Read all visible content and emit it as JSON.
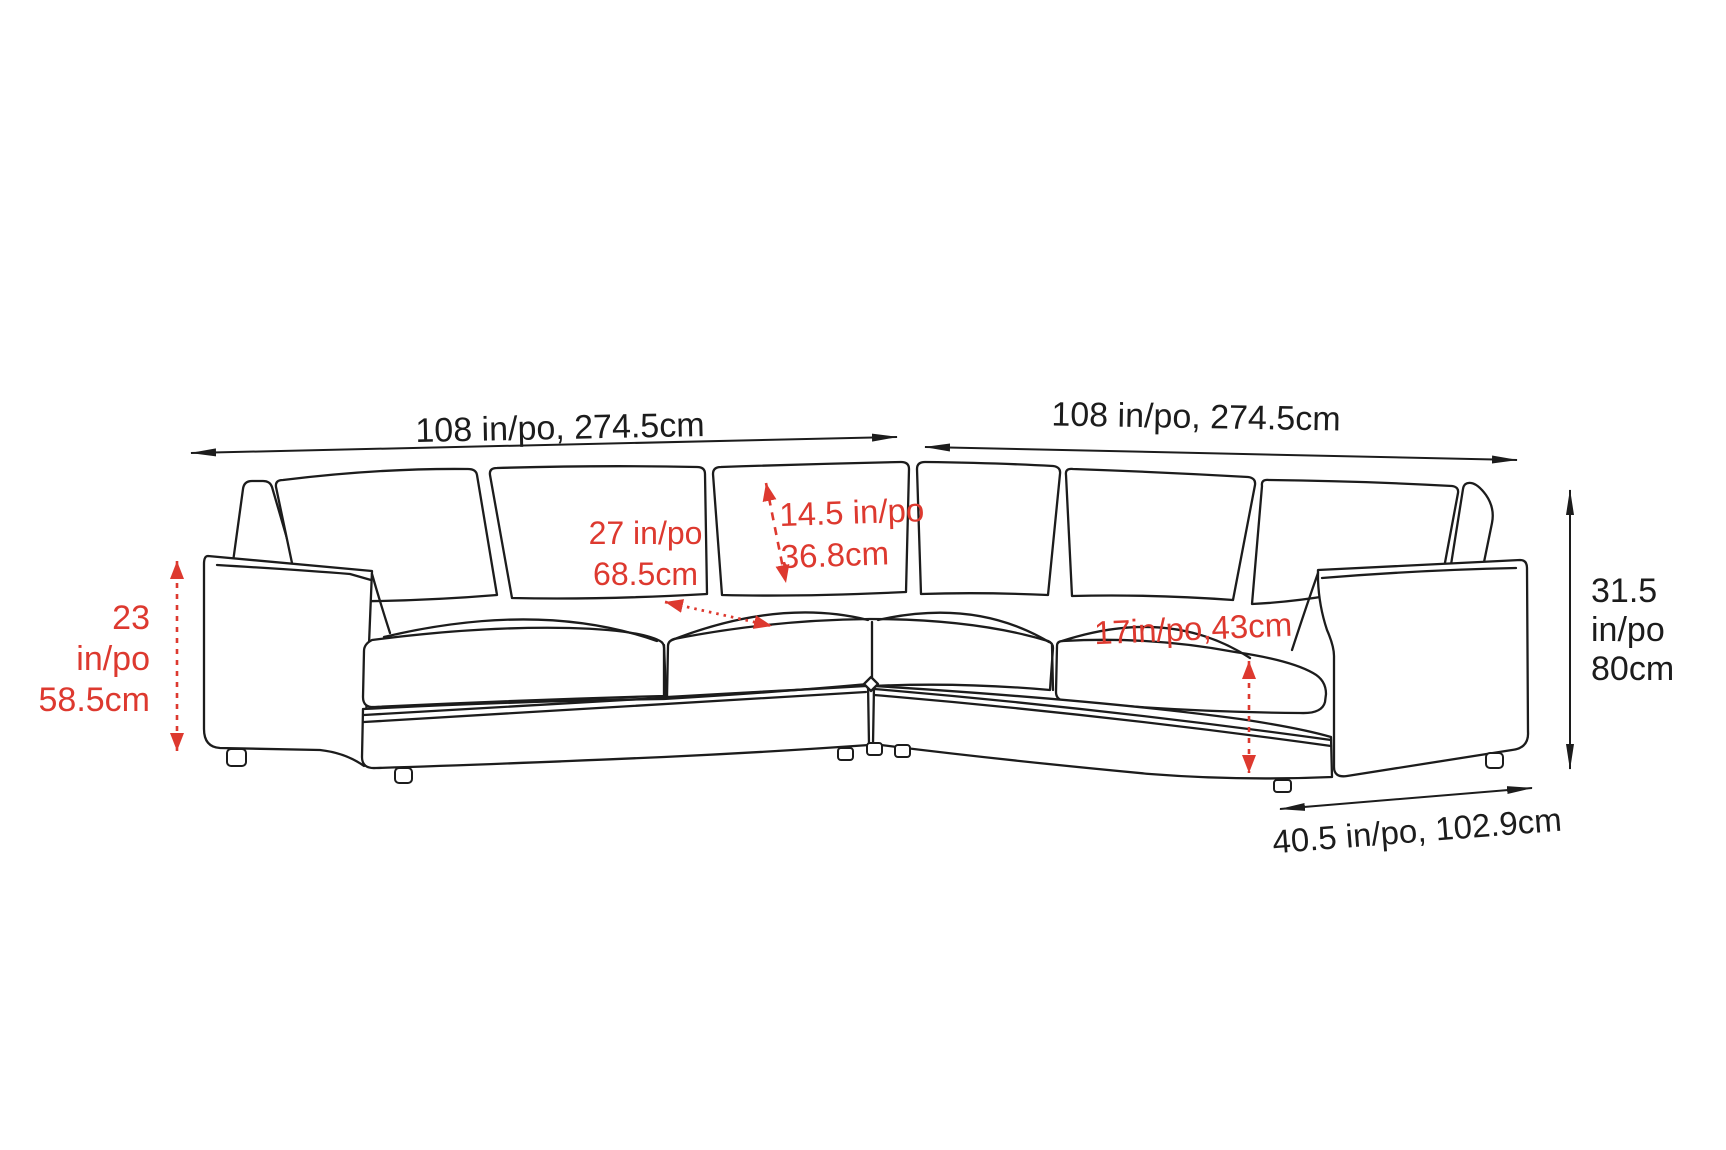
{
  "diagram": {
    "subject": "sectional-sofa-dimension-drawing",
    "colors": {
      "line": "#1c1c1c",
      "accent_red": "#dd392f",
      "background": "#ffffff"
    },
    "labels": {
      "width_left": "108 in/po, 274.5cm",
      "width_right": "108 in/po, 274.5cm",
      "back_height": [
        "23",
        "in/po",
        "58.5cm"
      ],
      "seat_depth": [
        "27 in/po",
        "68.5cm"
      ],
      "back_cushion_height": [
        "14.5 in/po",
        "36.8cm"
      ],
      "seat_height": "17in/po,43cm",
      "overall_height": [
        "31.5",
        "in/po",
        "80cm"
      ],
      "end_depth": "40.5 in/po, 102.9cm"
    }
  }
}
